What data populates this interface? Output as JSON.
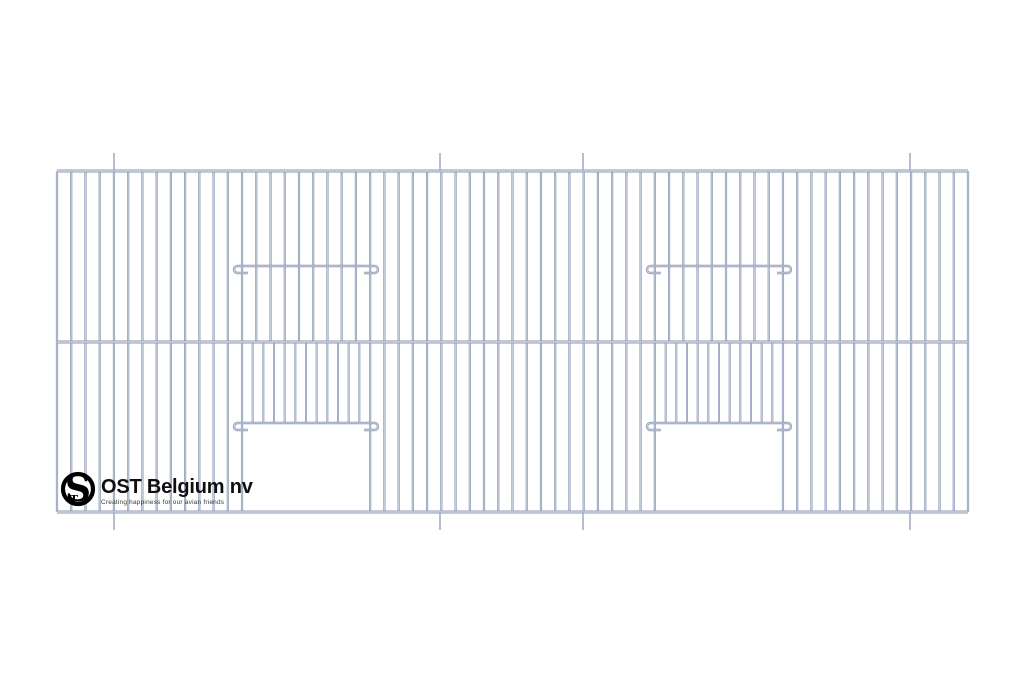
{
  "page": {
    "background": "#ffffff",
    "width": 1024,
    "height": 683,
    "description": "Technical line drawing of a wire cage-front panel with two sliding doors, branded OST Belgium nv"
  },
  "logo": {
    "name": "OST Belgium nv",
    "tagline": "Creating happiness for our avian friends",
    "monogram_main": "S",
    "monogram_sub": "T",
    "ring_color": "#000000",
    "text_color": "#0f0f0f",
    "tagline_color": "#3a3a3a"
  },
  "drawing": {
    "panel": {
      "left": 57,
      "right": 968,
      "top": 171,
      "mid": 342,
      "bottom": 512
    },
    "vertical_wire_count": 65,
    "openings": [
      {
        "left": 242,
        "right": 370,
        "door_bar_y": 423,
        "door_wire_count": 11
      },
      {
        "left": 655,
        "right": 783,
        "door_bar_y": 423,
        "door_wire_count": 11
      }
    ],
    "upper_bar_y": 266,
    "bar_overhang": 8,
    "hook_radius": 3.5,
    "hook_stub": 14,
    "marker_xs": [
      114,
      440,
      583,
      910
    ],
    "marker_len": 18,
    "colors": {
      "wire_edge": "#8a98b2",
      "wire_core": "#ccd4e2",
      "marker": "#a3afc4"
    }
  }
}
